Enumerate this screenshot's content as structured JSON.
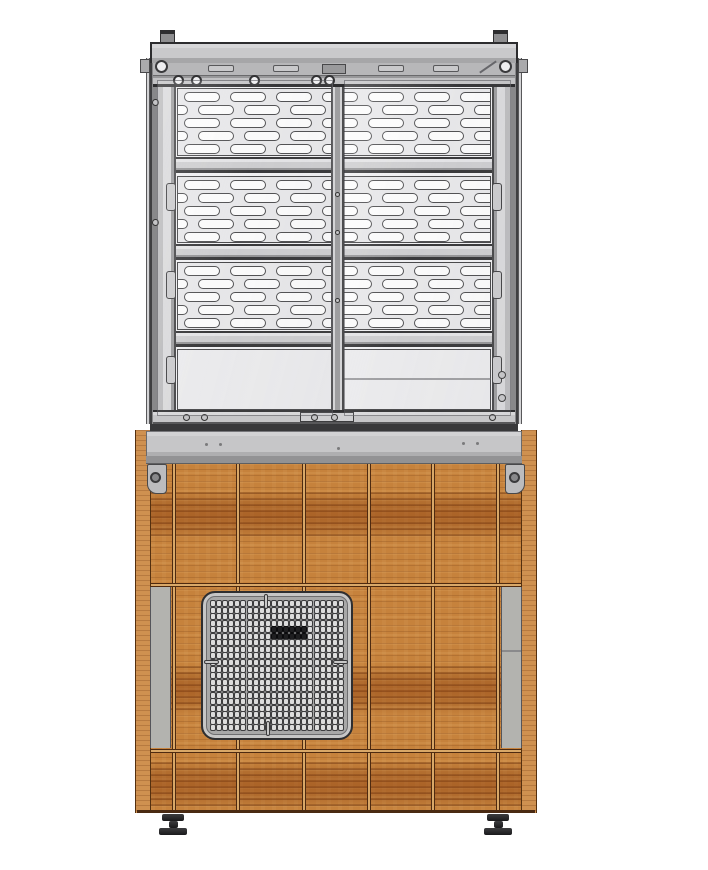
{
  "colors": {
    "bg": "#ffffff",
    "metal_light": "#c9c9cb",
    "metal_dark": "#38383a",
    "panel_bg": "#e6e6e8",
    "slot_fill": "#fbfbfb",
    "slot_outline": "#48484a",
    "countertop": "#c6c6c8",
    "wood": "#c6823c",
    "wood_streak": "#8a3e0e",
    "seam": "#4e2a10",
    "side_strip_gray": "#b3b3af",
    "grille_body": "#a8a8a8",
    "grille_hole": "#dcdcdc",
    "grille_hole_dark": "#1e1e20",
    "foot": "#242427"
  },
  "display_case": {
    "perforated_panels": 3,
    "slot_rows_per_panel": 5,
    "shelf_rails": 3,
    "sliding_doors": 2,
    "door_rollers": 5,
    "post_brackets_per_side": 3
  },
  "ventilation_grille": {
    "columns": 22,
    "rows": 20,
    "dark_rows": [
      4,
      5
    ],
    "dark_cols": [
      10,
      11,
      12,
      13,
      14,
      15
    ],
    "notches": 4
  },
  "base": {
    "front_vertical_seams": 6,
    "horizontal_seams": 2,
    "gray_side_columns": 2,
    "corner_brackets": 2,
    "adjustable_feet": 2
  }
}
